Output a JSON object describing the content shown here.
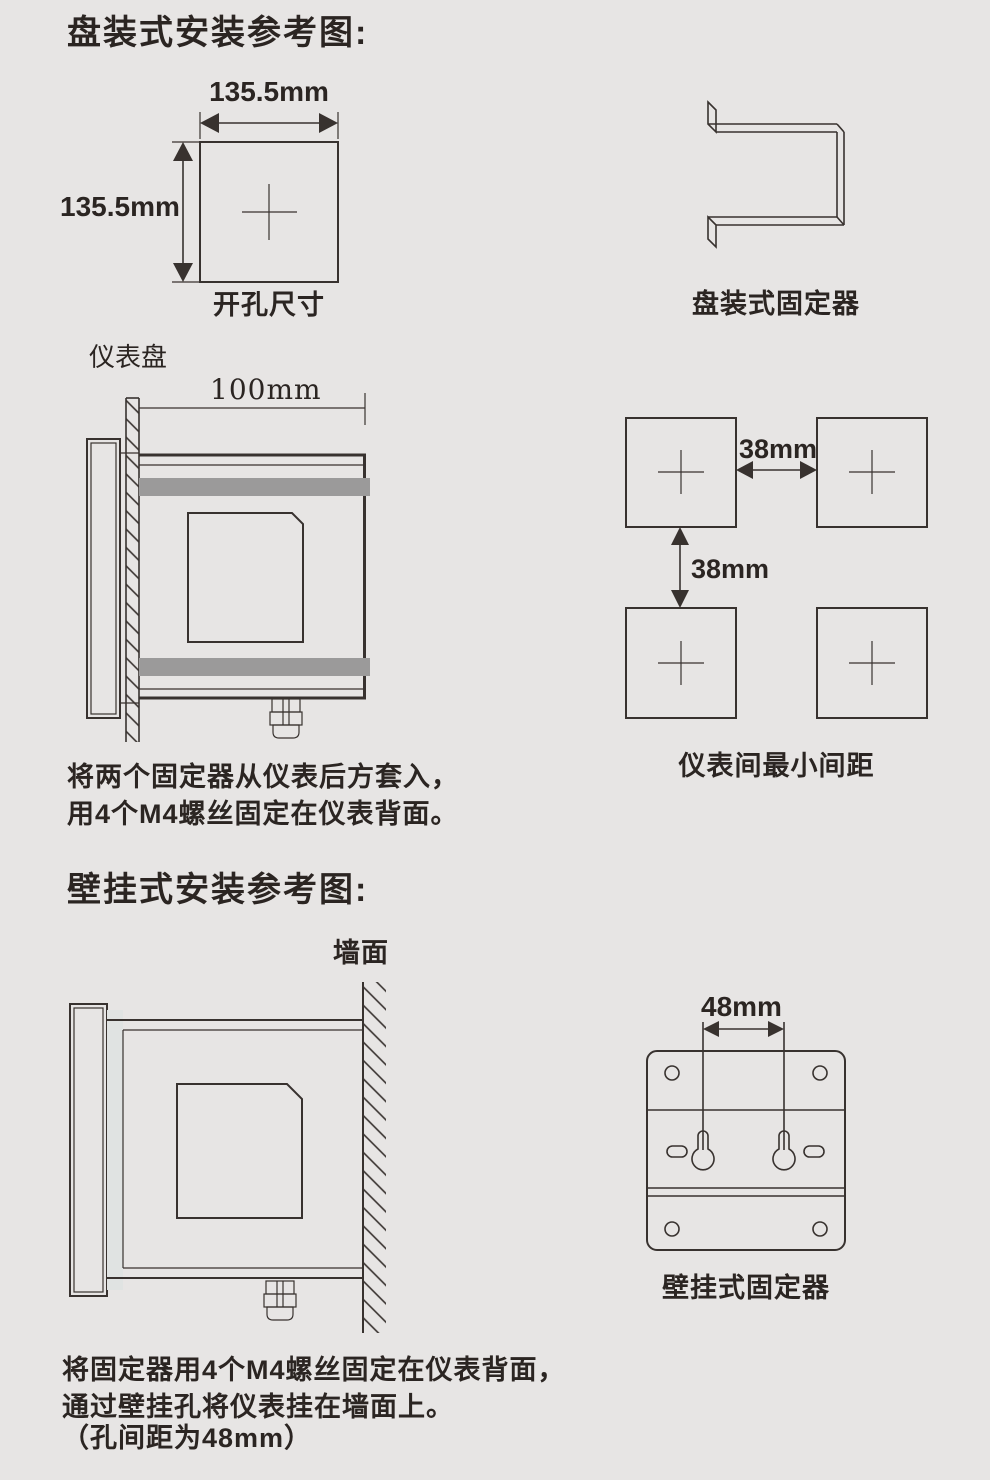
{
  "colors": {
    "background": "#e7e5e4",
    "line": "#38322f",
    "text": "#2b2522",
    "fixer_bar_gray": "#9b9a9a"
  },
  "panel_section": {
    "title": "盘装式安装参考图:",
    "cutout": {
      "width_label": "135.5mm",
      "height_label": "135.5mm",
      "caption": "开孔尺寸"
    },
    "bracket_caption": "盘装式固定器",
    "side_view": {
      "panel_label": "仪表盘",
      "depth_label": "100mm"
    },
    "spacing": {
      "horizontal_label": "38mm",
      "vertical_label": "38mm",
      "caption": "仪表间最小间距"
    },
    "note": {
      "line1": "将两个固定器从仪表后方套入，",
      "line2": "用4个M4螺丝固定在仪表背面。"
    }
  },
  "wall_section": {
    "title": "壁挂式安装参考图:",
    "wall_label": "墙面",
    "fixer": {
      "dim_label": "48mm",
      "caption": "壁挂式固定器"
    },
    "note": {
      "line1": "将固定器用4个M4螺丝固定在仪表背面，",
      "line2": "通过壁挂孔将仪表挂在墙面上。",
      "line3": "（孔间距为48mm）"
    }
  }
}
